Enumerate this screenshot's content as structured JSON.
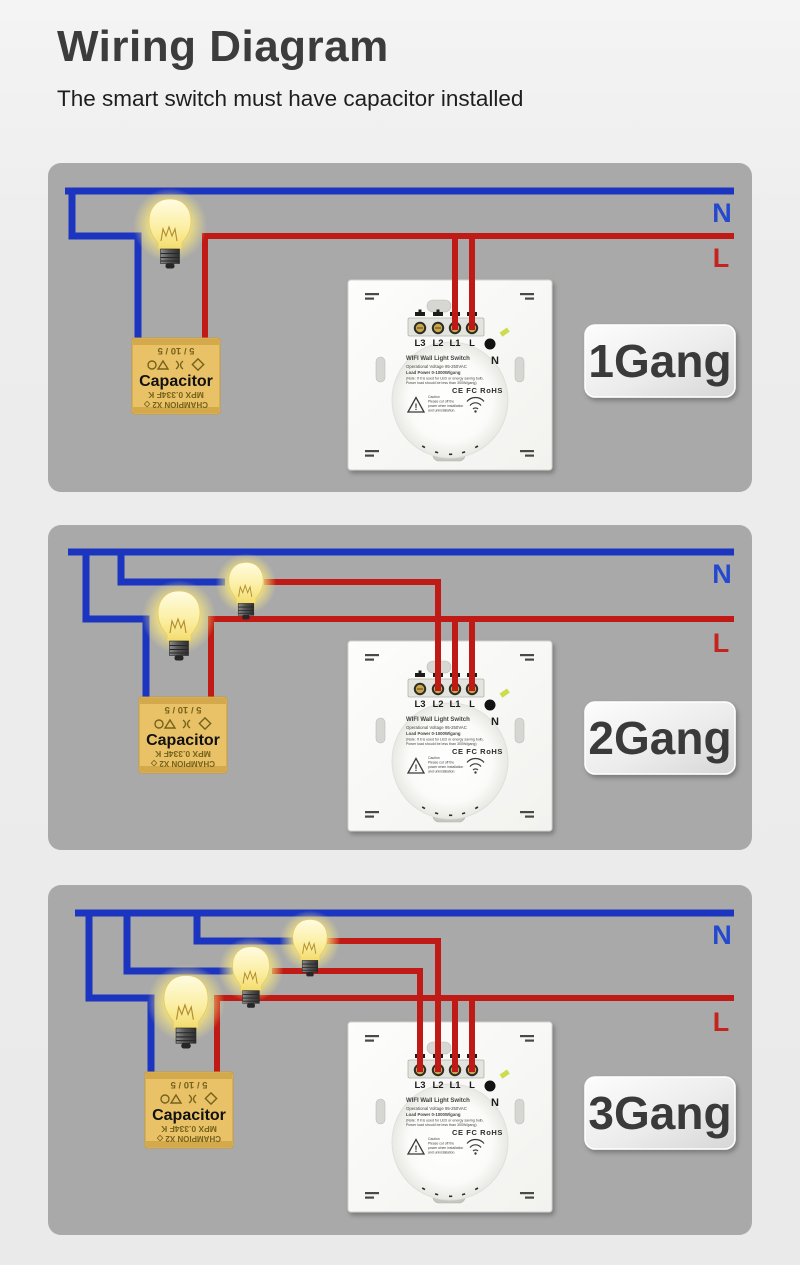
{
  "page": {
    "title": "Wiring Diagram",
    "subtitle": "The smart switch must have capacitor installed"
  },
  "labels": {
    "neutral": "N",
    "live": "L",
    "capacitor": "Capacitor"
  },
  "colors": {
    "neutral_wire": "#1c35c0",
    "live_wire": "#bf1a15",
    "neutral_label": "#2449cf",
    "live_label": "#c3241f",
    "panel_bg": "#a9a9a9",
    "badge_text": "#3a3a3a",
    "capacitor_body": "#e9c267",
    "bulb_glow": "#f7e57d"
  },
  "switch": {
    "name": "WIFI Wall Light Switch",
    "terminals": [
      "L3",
      "L2",
      "L1",
      "L"
    ],
    "neutral_terminal": "N",
    "spec_line1": "Operational Voltage 95-250VAC",
    "spec_line2": "Load Power 0-1000W/gang",
    "spec_line3": "(Note: If it is used for LED or energy saving bulb,",
    "spec_line4": "Power load should be less than 300W/gang)",
    "cert_marks": "CE FC RoHS",
    "caution_line1": "Caution",
    "caution_line2": "Please cut off the",
    "caution_line3": "power when installation",
    "caution_line4": "and uninstallation."
  },
  "capacitor_markings": {
    "line1": "5 / 10 / 5",
    "line2": "MPX 0.334F K",
    "line3": "CHAMPION X2 ◇"
  },
  "panels": [
    {
      "gang_label": "1Gang",
      "bulbs": 1,
      "load_terminals_used": [
        "L1"
      ]
    },
    {
      "gang_label": "2Gang",
      "bulbs": 2,
      "load_terminals_used": [
        "L1",
        "L2"
      ]
    },
    {
      "gang_label": "3Gang",
      "bulbs": 3,
      "load_terminals_used": [
        "L1",
        "L2",
        "L3"
      ]
    }
  ]
}
